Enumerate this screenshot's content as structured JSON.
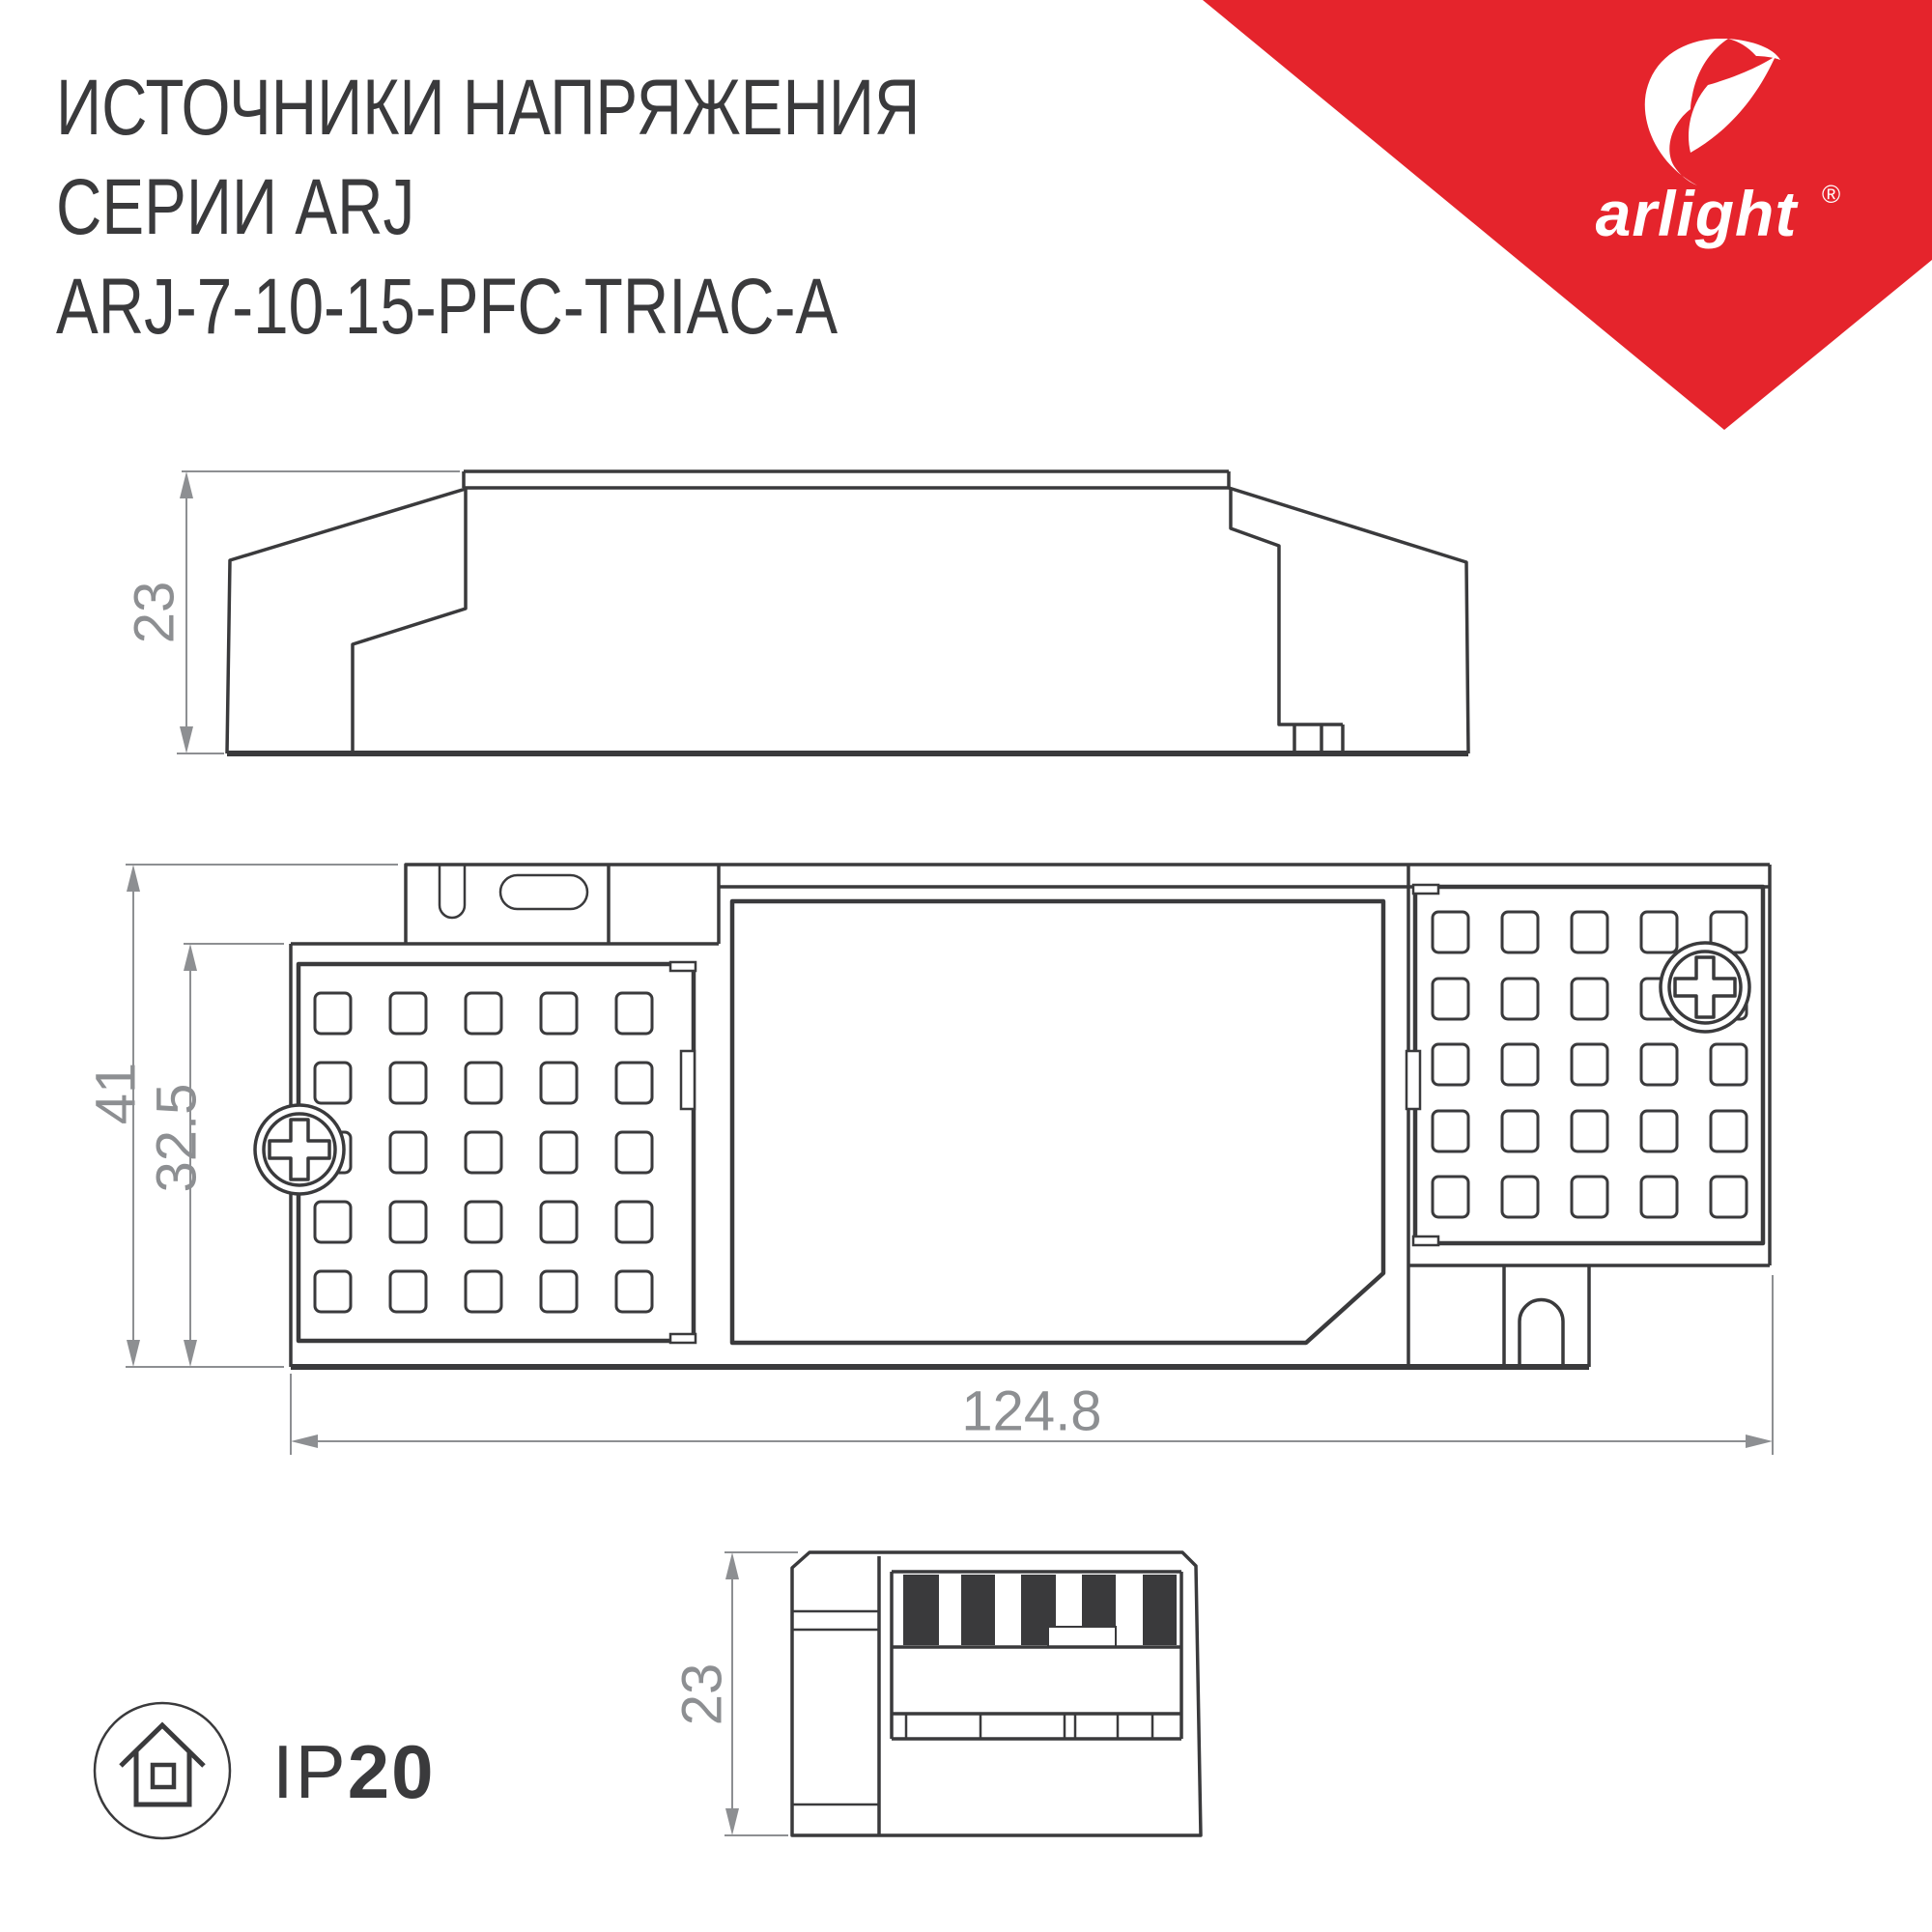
{
  "title": {
    "line1": "ИСТОЧНИКИ НАПРЯЖЕНИЯ",
    "line2": "СЕРИИ ARJ",
    "line3": "ARJ-7-10-15-PFC-TRIAC-A"
  },
  "logo": {
    "brand": "arlight",
    "registered": "®"
  },
  "views": {
    "side_view": {
      "height_label": "23"
    },
    "top_view": {
      "overall_width_label": "41",
      "inner_width_label": "32.5",
      "length_label": "124.8"
    },
    "end_view": {
      "height_label": "23"
    }
  },
  "protection": {
    "prefix": "IP",
    "rating": "20"
  },
  "colors": {
    "accent_red": "#e5242c",
    "drawing_line": "#3a3a3c",
    "dimension_gray": "#8d8f92"
  }
}
